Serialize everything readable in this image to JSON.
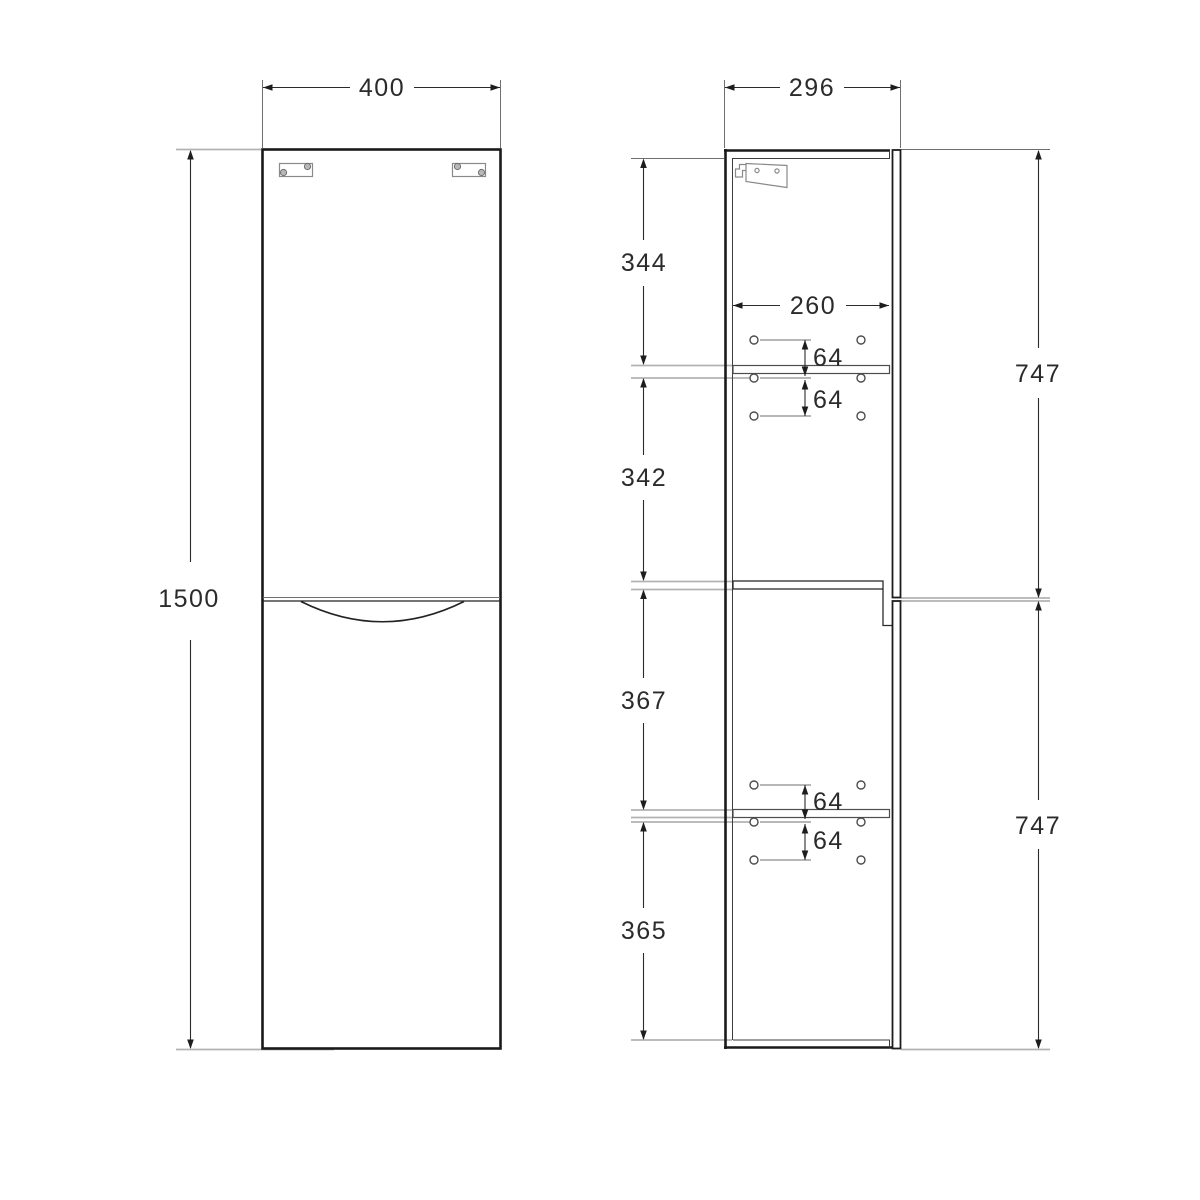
{
  "diagram": {
    "front": {
      "dims": {
        "width": "400",
        "height": "1500"
      }
    },
    "side": {
      "dims": {
        "depth": "296",
        "interior_width": "260",
        "seg_top": "344",
        "seg_upper_mid": "342",
        "seg_lower_mid": "367",
        "seg_bottom": "365",
        "door_upper": "747",
        "door_lower": "747",
        "pin_pitch_top_a": "64",
        "pin_pitch_top_b": "64",
        "pin_pitch_bottom_a": "64",
        "pin_pitch_bottom_b": "64"
      }
    },
    "colors": {
      "background": "#ffffff",
      "object_line": "#1a1a1a",
      "dimension_line": "#2b2b2b",
      "extension_line": "#b3b3b3",
      "hardware_line": "#8a8a8a",
      "text": "#2b2b2b"
    }
  }
}
